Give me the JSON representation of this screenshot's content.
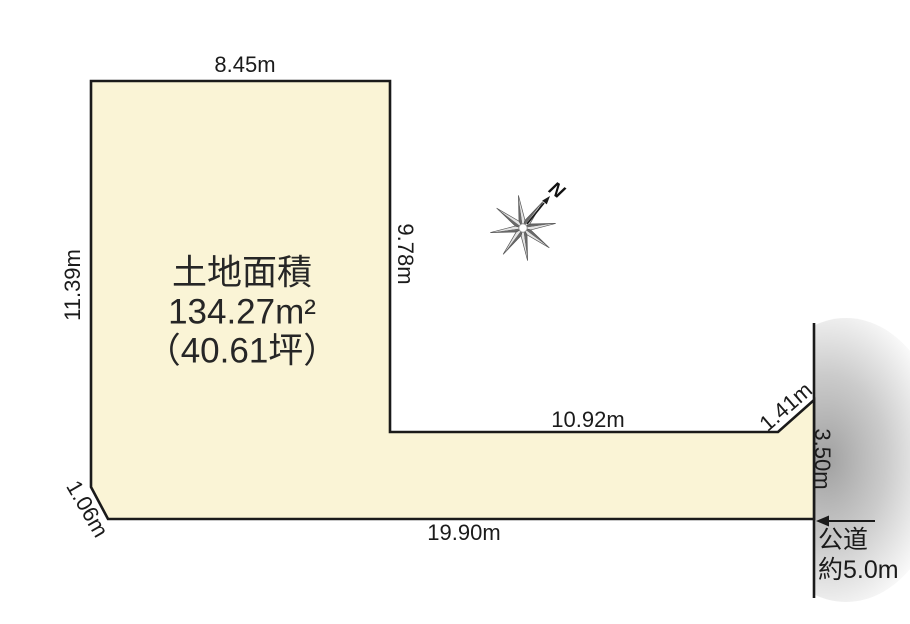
{
  "diagram": {
    "type": "land-plot-survey",
    "area_title": "土地面積",
    "area_m2": "134.27m²",
    "area_tsubo": "（40.61坪）",
    "north_label": "N",
    "road_label_line1": "公道",
    "road_label_line2": "約5.0m",
    "dimensions": {
      "top_edge": "8.45m",
      "left_edge": "11.39m",
      "inner_vertical_edge": "9.78m",
      "inner_horizontal_edge": "10.92m",
      "corner_cut_right": "1.41m",
      "right_edge": "3.50m",
      "bottom_edge": "19.90m",
      "corner_cut_left": "1.06m"
    },
    "colors": {
      "plot_fill": "#FAF4D6",
      "outline": "#1A1A1A",
      "road_shadow": "#8F8F8F",
      "text": "#1B1B1B"
    }
  }
}
